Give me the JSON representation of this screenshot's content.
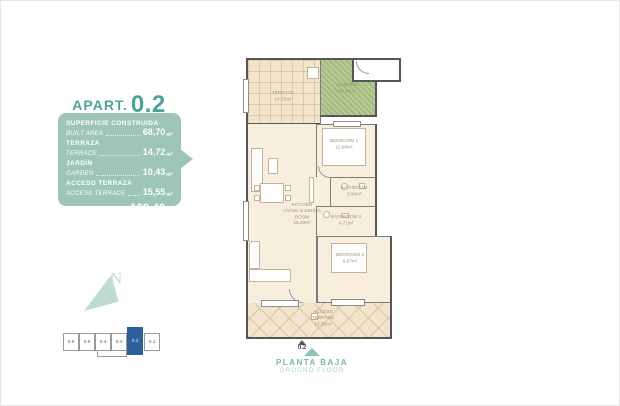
{
  "title": {
    "prefix": "APART.",
    "number": "0.2"
  },
  "area_panel": {
    "rows": [
      {
        "es": "SUPERFICIE CONSTRUIDA",
        "en": "BUILT AREA",
        "value": "68,70",
        "unit": "m²"
      },
      {
        "es": "TERRAZA",
        "en": "TERRACE",
        "value": "14,72",
        "unit": "m²"
      },
      {
        "es": "JARDÍN",
        "en": "GARDEN",
        "value": "10,43",
        "unit": "m²"
      },
      {
        "es": "ACCESO TERRAZA",
        "en": "ACCESS TERRACE",
        "value": "15,55",
        "unit": "m²"
      }
    ],
    "total": {
      "label": "TOTAL",
      "value": "109,40",
      "unit": "m²"
    }
  },
  "plan": {
    "terrace": {
      "name": "TERRACE",
      "area": "14.72m²"
    },
    "garden": {
      "name": "GARDEN",
      "area": "10.43m²"
    },
    "bedroom1": {
      "name": "BEDROOM 1",
      "area": "11.09m²"
    },
    "living": {
      "line1": "KITCHEN",
      "line2": "LIVING & DINING",
      "line3": "ROOM",
      "area": "36.29m²"
    },
    "bathroom1": {
      "name": "BATHROOM",
      "area": "3.00m²"
    },
    "bathroom2": {
      "name": "BATHROOM 2",
      "area": "4.71m²"
    },
    "bedroom2": {
      "name": "BEDROOM 2",
      "area": "8.87m²"
    },
    "access": {
      "line1": "ACCESS",
      "line2": "TERRACE",
      "area": "15.55m²"
    },
    "entrance_label": "0.2"
  },
  "key_plan": {
    "units": [
      "0.6",
      "0.5",
      "0.4",
      "0.3",
      "0.2",
      "0.1"
    ],
    "highlighted_unit": "0.2"
  },
  "compass": {
    "label": "N"
  },
  "footer": {
    "es": "PLANTA BAJA",
    "en": "GROUND FLOOR"
  },
  "colors": {
    "teal": "#4ca495",
    "panel_bg": "#9dc6b9",
    "highlight_blue": "#2f5f9d",
    "garden_green": "#b7c993",
    "terrace_tan": "#f3e5cc"
  }
}
